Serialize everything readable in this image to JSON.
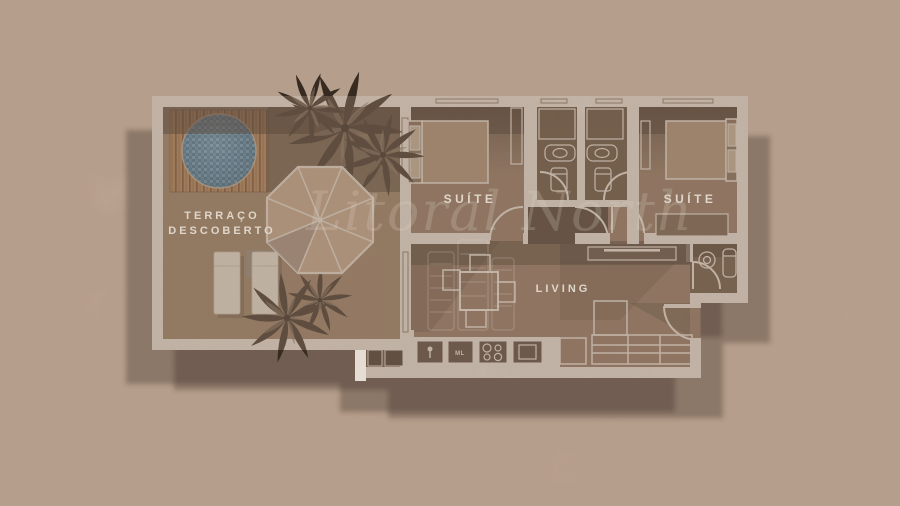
{
  "plan": {
    "type": "apartment-floor-plan",
    "watermark": "Litoral North",
    "rooms": {
      "terrace": {
        "label_line1": "TERRAÇO",
        "label_line2": "DESCOBERTO"
      },
      "suite_left": {
        "label": "SUÍTE"
      },
      "suite_right": {
        "label": "SUÍTE"
      },
      "living": {
        "label": "LIVING"
      }
    },
    "kitchen": {
      "microwave_label": "ML"
    },
    "features": [
      "round-pool",
      "wood-deck",
      "parasol",
      "sun-loungers",
      "palm-plants",
      "two-suites",
      "two-bathrooms",
      "lavabo",
      "kitchen-counter",
      "l-sofa",
      "dining-table-4-chairs",
      "tv-console"
    ],
    "colors": {
      "paper": "#c9b1a0",
      "wall": "#f6f0e8",
      "floor": "#8d715c",
      "floor_dark": "#4e3b2c",
      "shadow": "#3f2e22",
      "deck_wood": "#b2804f",
      "pool_water": "#3d85b4",
      "umbrella": "#c8a98e",
      "label_text": "#efe7db"
    }
  }
}
